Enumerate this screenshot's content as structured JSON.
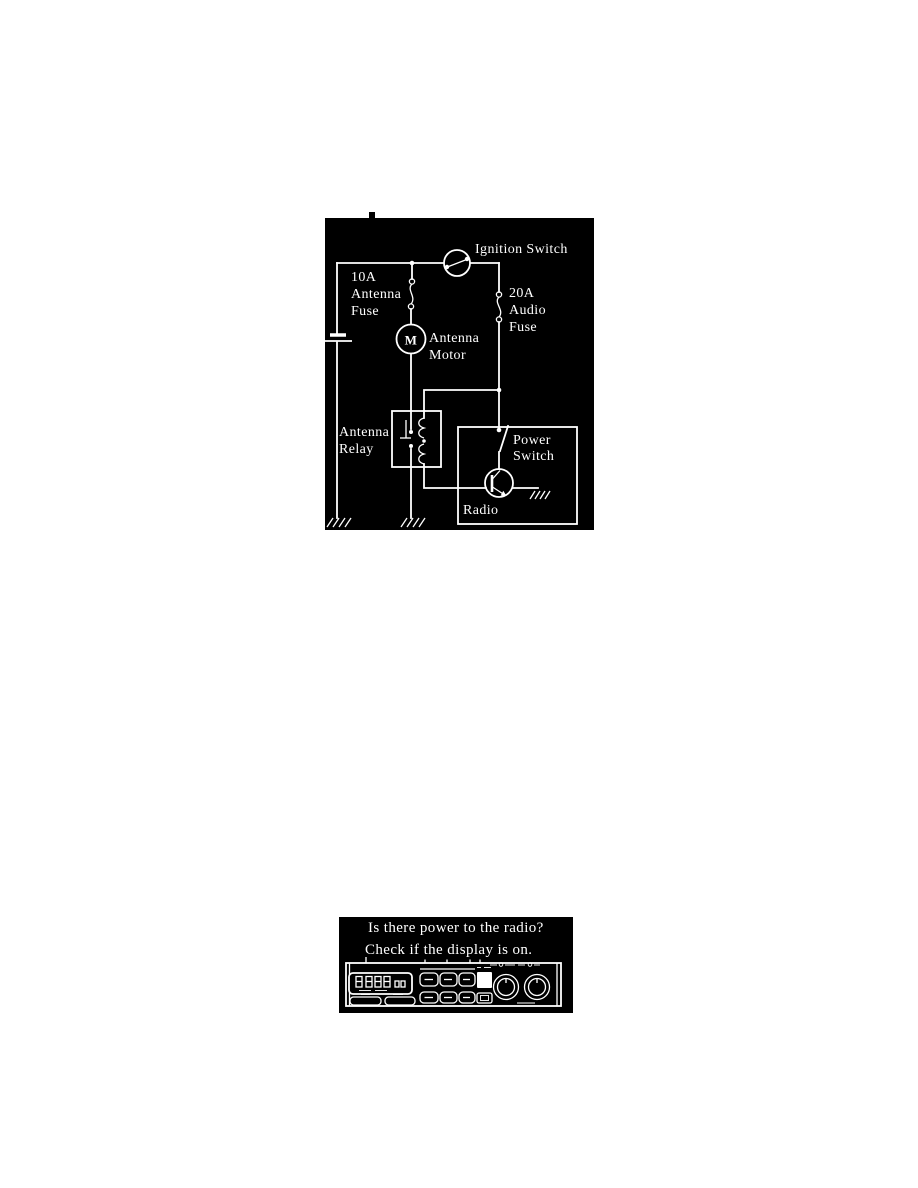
{
  "page": {
    "background": "#ffffff"
  },
  "figure_top": {
    "type": "wiring-diagram",
    "colors": {
      "background": "#000000",
      "line": "#ffffff"
    },
    "labels": {
      "ignition_switch": "Ignition Switch",
      "antenna_fuse": [
        "10A",
        "Antenna",
        "Fuse"
      ],
      "audio_fuse": [
        "20A",
        "Audio",
        "Fuse"
      ],
      "antenna_motor": [
        "Antenna",
        "Motor"
      ],
      "motor_letter": "M",
      "antenna_relay": [
        "Antenna",
        "Relay"
      ],
      "power_switch": [
        "Power",
        "Switch"
      ],
      "radio": "Radio"
    }
  },
  "figure_bottom": {
    "type": "troubleshooting-check",
    "colors": {
      "background": "#000000",
      "line": "#ffffff"
    },
    "question": [
      "Is there power to the radio?",
      "Check if the display is on."
    ]
  }
}
